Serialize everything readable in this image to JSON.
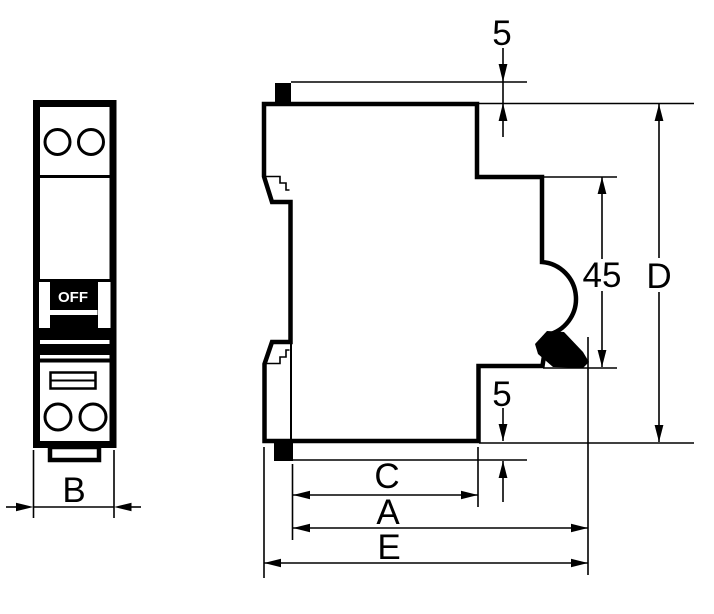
{
  "colors": {
    "background": "#ffffff",
    "ink": "#000000"
  },
  "front_view": {
    "toggle_state_label": "OFF",
    "width_dim_label": "B"
  },
  "side_view": {
    "toggle_protrusion_dim_label": "5",
    "front_section_height_dim_label": "45",
    "overall_height_dim_label": "D",
    "clip_protrusion_dim_label": "5",
    "recess_width_dim_label": "C",
    "mounting_depth_dim_label": "A",
    "overall_depth_dim_label": "E"
  }
}
